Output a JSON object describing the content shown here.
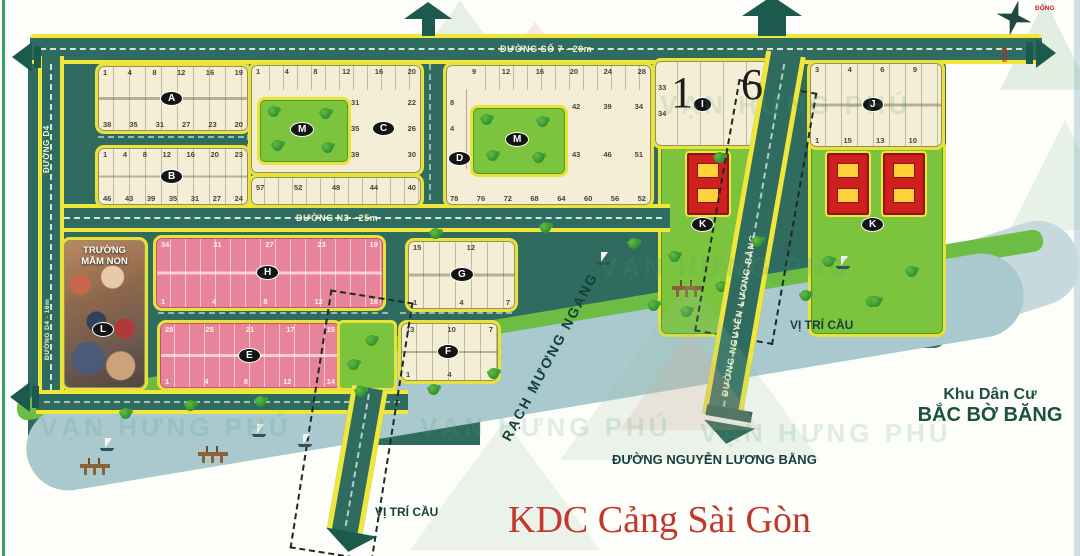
{
  "title": "KDC Cảng Sài Gòn",
  "watermark": "VẠN HƯNG PHÚ",
  "compass": {
    "east": "ĐÔNG",
    "south": "NAM"
  },
  "roads": {
    "so7": "ĐƯỜNG SỐ 7 - 20m",
    "n3": "ĐƯỜNG N3 - 25m",
    "d4": "ĐƯỜNG D4",
    "d4_16": "ĐƯỜNG D4 - 16m",
    "nlb_vertical": "ĐƯỜNG NGUYỄN LƯƠNG BẰNG",
    "nlb_bottom": "ĐƯỜNG NGUYỄN LƯƠNG BẰNG"
  },
  "labels": {
    "bridge_right": "VỊ TRÍ CẦU",
    "bridge_left": "VỊ TRÍ CẦU",
    "canal": "RẠCH MƯƠNG NGANG",
    "neighbor_line1": "Khu Dân Cư",
    "neighbor_line2": "BẮC BỜ BĂNG",
    "school_line1": "TRƯỜNG",
    "school_line2": "MẦM NON"
  },
  "blocks": {
    "A": {
      "label": "A",
      "top": [
        "1",
        "4",
        "8",
        "12",
        "16",
        "19"
      ],
      "bottom": [
        "38",
        "35",
        "31",
        "27",
        "23",
        "20"
      ]
    },
    "B": {
      "label": "B",
      "top": [
        "1",
        "4",
        "8",
        "12",
        "16",
        "20",
        "23"
      ],
      "bottom": [
        "46",
        "43",
        "39",
        "35",
        "31",
        "27",
        "24"
      ]
    },
    "C": {
      "label": "C",
      "top": [
        "1",
        "4",
        "8",
        "12",
        "16",
        "20"
      ],
      "mid1": [
        "31",
        "22"
      ],
      "mid2_left": "35",
      "mid2_right": "26",
      "mid3": [
        "39",
        "30"
      ],
      "strip": [
        "57",
        "52",
        "48",
        "44",
        "40"
      ]
    },
    "D": {
      "label": "D",
      "top": [
        "9",
        "12",
        "16",
        "20",
        "24",
        "28"
      ],
      "left": [
        "8",
        "4",
        "1"
      ],
      "mid": [
        "42",
        "39",
        "34"
      ],
      "lower": [
        "43",
        "46",
        "51"
      ],
      "bottom": [
        "78",
        "76",
        "72",
        "68",
        "64",
        "60",
        "56",
        "52"
      ]
    },
    "I": {
      "label": "I",
      "left": [
        "33",
        "34"
      ],
      "overlay": [
        "1",
        "6"
      ]
    },
    "J": {
      "label": "J",
      "top": [
        "3",
        "4",
        "6",
        "9"
      ],
      "bottom": [
        "1",
        "15",
        "13",
        "10"
      ]
    },
    "K1": {
      "label": "K"
    },
    "K2": {
      "label": "K"
    },
    "L": {
      "label": "L"
    },
    "M1": {
      "label": "M"
    },
    "M2": {
      "label": "M"
    },
    "H": {
      "label": "H",
      "top": [
        "34",
        "31",
        "27",
        "23",
        "19"
      ],
      "bottom": [
        "1",
        "4",
        "8",
        "12",
        "16"
      ]
    },
    "E": {
      "label": "E",
      "top": [
        "28",
        "25",
        "21",
        "17",
        "15"
      ],
      "bottom": [
        "1",
        "4",
        "8",
        "12",
        "14"
      ]
    },
    "G": {
      "label": "G",
      "top": [
        "15",
        "12"
      ],
      "bottom": [
        "1",
        "4",
        "7"
      ]
    },
    "F": {
      "label": "F",
      "top": [
        "13",
        "10",
        "7"
      ],
      "bottom": [
        "1",
        "4",
        "6"
      ]
    }
  },
  "colors": {
    "map_teal": "#2f6b5e",
    "road_yellow": "#efe73a",
    "block_cream": "#f4eed6",
    "block_pink": "#e8849a",
    "park_green": "#7cc43e",
    "building_red": "#d01f1f",
    "water_blue": "#a9c9ce",
    "title_red": "#c2392b"
  }
}
